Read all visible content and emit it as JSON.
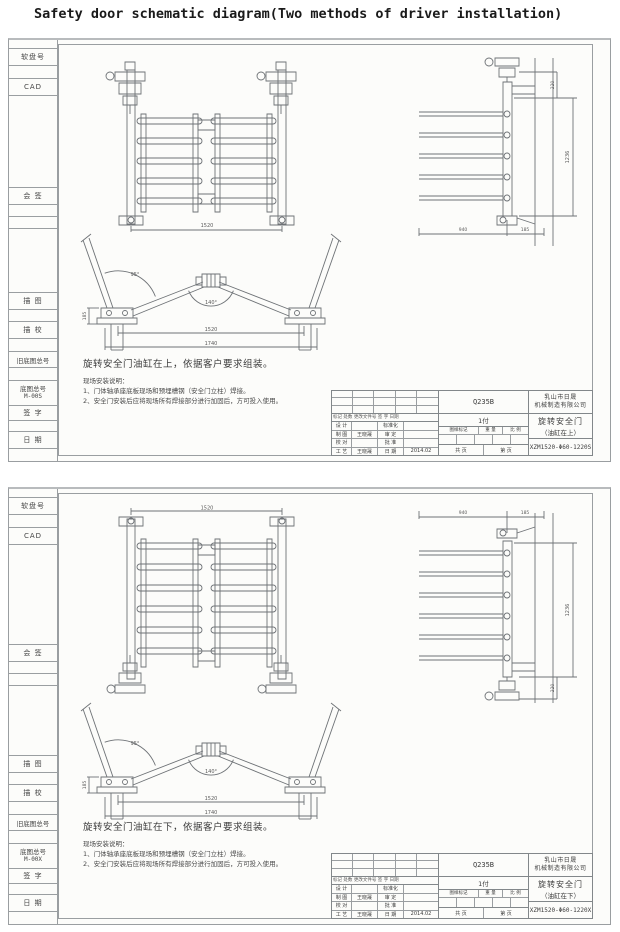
{
  "page": {
    "title": "Safety door schematic diagram(Two methods of driver installation)"
  },
  "sidebar": {
    "disk_no": "软盘号",
    "cad": "CAD",
    "countersign": "会  签",
    "trace": "描  图",
    "trace_check": "描  校",
    "old_base_no": "旧底图总号",
    "base_no": "底图总号",
    "sign": "签  字",
    "date": "日  期"
  },
  "title_block": {
    "rev_header": "标记 处数 更改文件号 签 字 日期",
    "design": "设 计",
    "draft": "制 图",
    "check": "校 对",
    "process": "工 艺",
    "standardization": "标准化",
    "review": "审 定",
    "approve": "批 准",
    "date": "日 期",
    "stamp": "图样标记",
    "weight": "重 量",
    "scale": "比 例",
    "total": "共  页",
    "page": "第  页"
  },
  "sheets": [
    {
      "base_no_value": "M-00S",
      "material": "Q235B",
      "quantity": "1付",
      "company_line1": "乳山市日晟",
      "company_line2": "机械制造有限公司",
      "product_line1": "旋转安全门",
      "product_line2": "（油缸在上）",
      "drawing_no": "XZM1520-Φ60-1220S",
      "draft_name": "王晓晟",
      "process_name": "王晓晟",
      "date_value": "2014.02",
      "note_title": "旋转安全门油缸在上，依据客户要求组装。",
      "note_heading": "现场安装说明：",
      "note_line1": "1、门体轴承座底板现场和预埋槽钢（安全门立柱）焊接。",
      "note_line2": "2、安全门安装后应将现场所有焊接部分进行加固后，方可投入使用。",
      "dims": {
        "front_width": "1520",
        "side_height": "1236",
        "side_top": "220",
        "side_bottom1": "940",
        "side_bottom2": "185",
        "open_width1": "1520",
        "open_width2": "1740",
        "open_height": "185",
        "angle_open": "95°",
        "angle_center": "140°"
      }
    },
    {
      "base_no_value": "M-00X",
      "material": "Q235B",
      "quantity": "1付",
      "company_line1": "乳山市日晟",
      "company_line2": "机械制造有限公司",
      "product_line1": "旋转安全门",
      "product_line2": "（油缸在下）",
      "drawing_no": "XZM1520-Φ60-1220X",
      "draft_name": "王晓晟",
      "process_name": "王晓晟",
      "date_value": "2014.02",
      "note_title": "旋转安全门油缸在下，依据客户要求组装。",
      "note_heading": "现场安装说明：",
      "note_line1": "1、门体轴承座底板现场和预埋槽钢（安全门立柱）焊接。",
      "note_line2": "2、安全门安装后应将现场所有焊接部分进行加固后，方可投入使用。",
      "dims": {
        "front_width": "1520",
        "side_height": "1236",
        "side_top": "220",
        "side_bottom1": "940",
        "side_bottom2": "185",
        "open_width1": "1520",
        "open_width2": "1740",
        "open_height": "185",
        "angle_open": "95°",
        "angle_center": "140°"
      }
    }
  ]
}
